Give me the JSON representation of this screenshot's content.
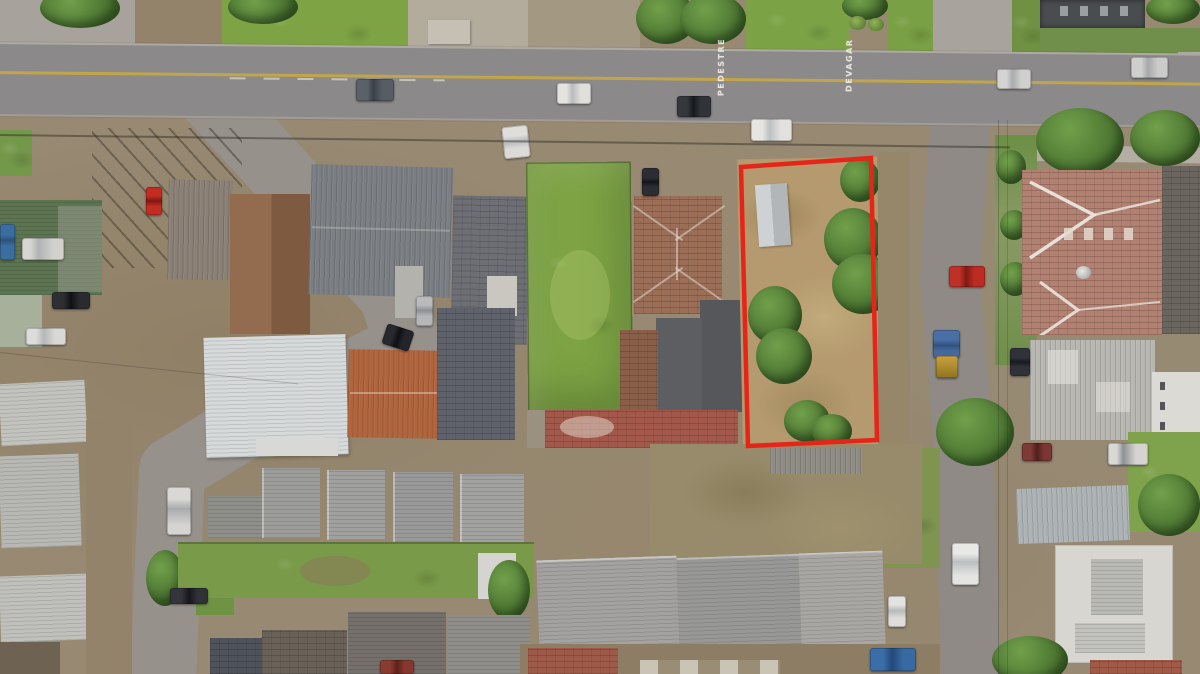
{
  "scene": {
    "type": "aerial-drone-photograph",
    "road_markings": {
      "pedestre": "PEDESTRE",
      "devagar": "DEVAGAR"
    }
  },
  "colors": {
    "boundary-red": "#e62417",
    "road-asphalt": "#8c898a",
    "side-street-asphalt": "#97918b",
    "center-line-yellow": "#c7a843",
    "lawn-green": "#7da344",
    "dry-grass-tan": "#b49a6e",
    "tree-green": "#47702e"
  }
}
